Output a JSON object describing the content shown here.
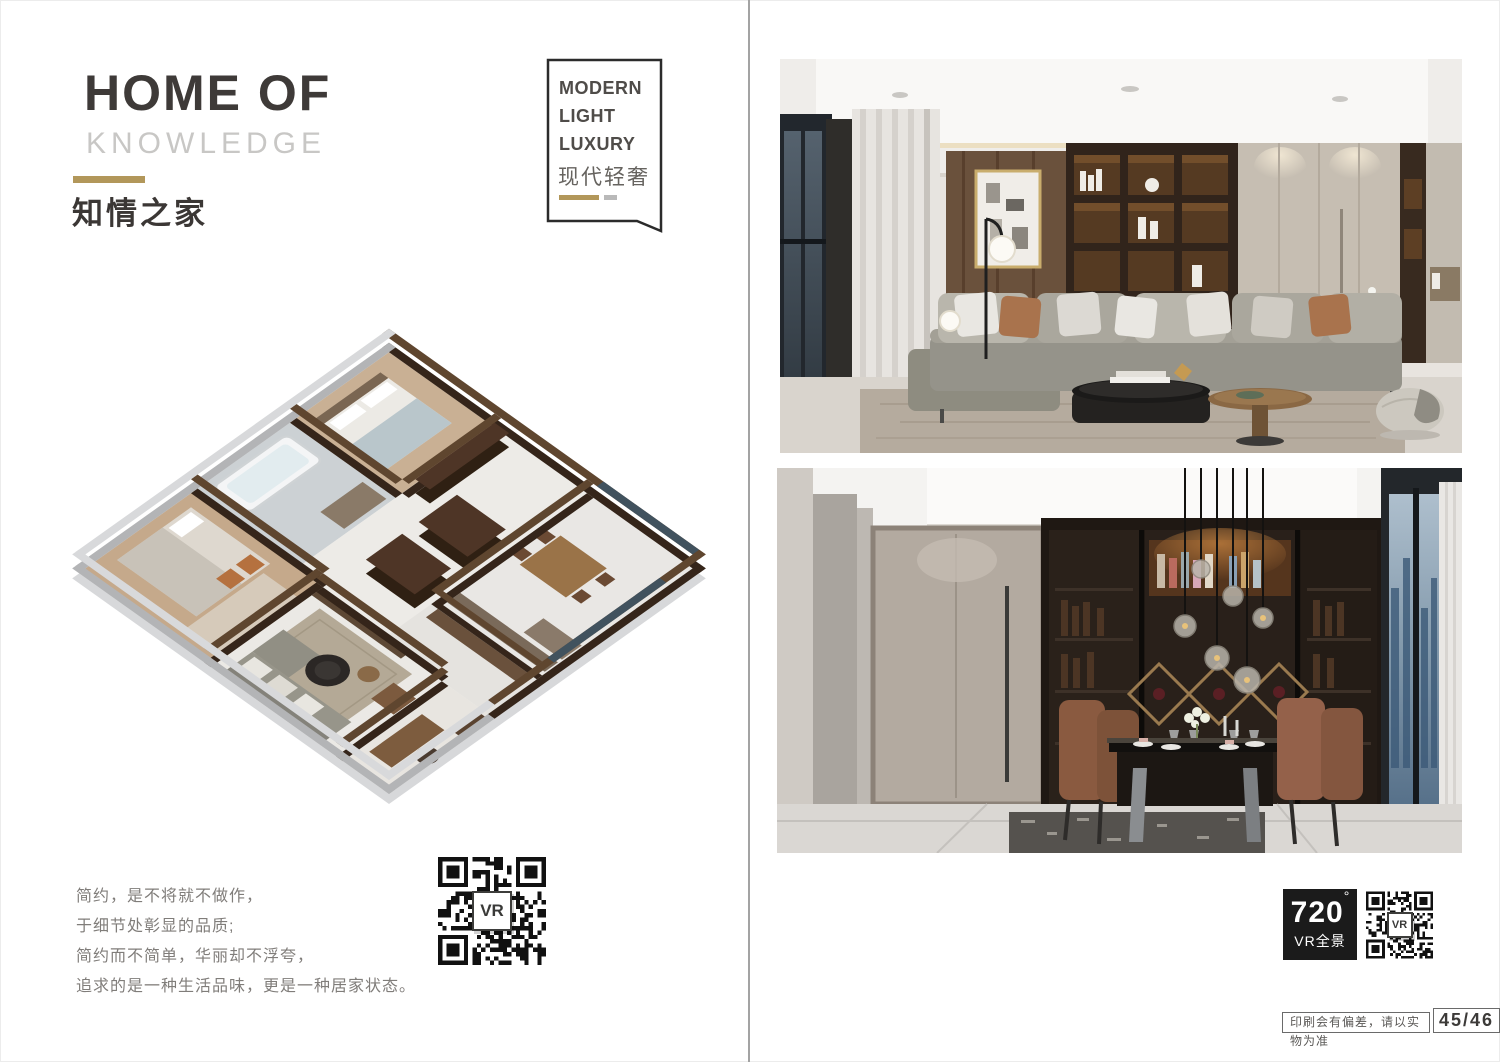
{
  "colors": {
    "accent_gold": "#b2975a",
    "title_dark": "#3e3a38",
    "title_light_gray": "#c8c7c5",
    "badge_border": "#2b2b2b",
    "vr_badge_bg": "#1b1b1b"
  },
  "left_page": {
    "title_line1": "HOME OF",
    "title_line2": "KNOWLEDGE",
    "title_cn": "知情之家",
    "badge": {
      "line1": "MODERN",
      "line2": "LIGHT",
      "line3": "LUXURY",
      "cn": "现代轻奢"
    },
    "quote": [
      "简约，是不将就不做作，",
      "于细节处彰显的品质;",
      "简约而不简单，华丽却不浮夸，",
      "追求的是一种生活品味，更是一种居家状态。"
    ],
    "qr_label": "VR"
  },
  "right_page": {
    "vr_badge": {
      "number": "720",
      "degree": "°",
      "label": "VR全景"
    },
    "qr_label": "VR",
    "print_note": "印刷会有偏差，请以实物为准",
    "page_number": "45/46"
  }
}
